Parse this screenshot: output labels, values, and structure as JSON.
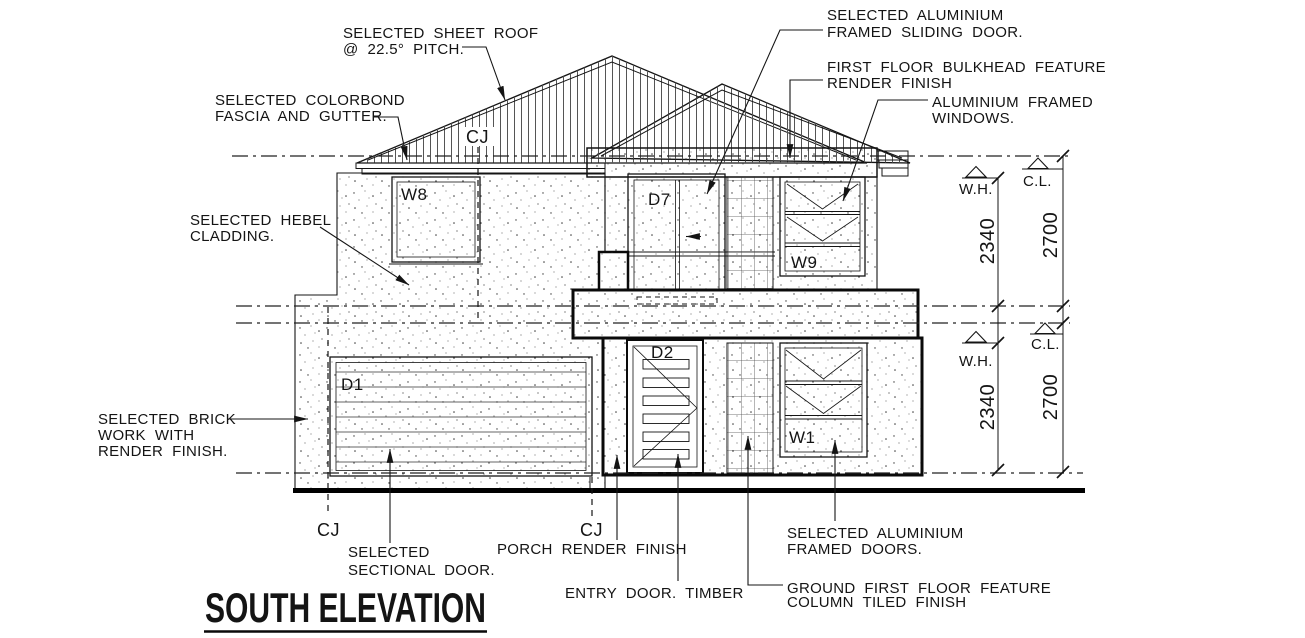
{
  "drawing_title": "SOUTH ELEVATION",
  "callouts": {
    "sheet_roof": {
      "line1": "SELECTED SHEET ROOF",
      "line2": "@ 22.5° PITCH."
    },
    "fascia": {
      "line1": "SELECTED COLORBOND",
      "line2": "FASCIA AND GUTTER."
    },
    "cladding": {
      "line1": "SELECTED HEBEL",
      "line2": "CLADDING."
    },
    "sliding_door": {
      "line1": "SELECTED ALUMINIUM",
      "line2": "FRAMED SLIDING DOOR."
    },
    "bulkhead": {
      "line1": "FIRST FLOOR BULKHEAD FEATURE",
      "line2": "RENDER FINISH"
    },
    "alum_windows": {
      "line1": "ALUMINIUM FRAMED",
      "line2": "WINDOWS."
    },
    "brickwork": {
      "line1": "SELECTED BRICK",
      "line2": "WORK WITH",
      "line3": "RENDER FINISH."
    },
    "sectional_door": {
      "line1": "SELECTED",
      "line2": "SECTIONAL DOOR."
    },
    "porch": "PORCH RENDER FINISH",
    "entry_door": "ENTRY DOOR. TIMBER",
    "framed_doors": {
      "line1": "SELECTED ALUMINIUM",
      "line2": "FRAMED DOORS."
    },
    "feature_column": {
      "line1": "GROUND FIRST FLOOR FEATURE",
      "line2": "COLUMN TILED FINISH"
    }
  },
  "tags": {
    "window_w8": "W8",
    "door_d7": "D7",
    "window_w9": "W9",
    "garage_d1": "D1",
    "entry_d2": "D2",
    "window_w1": "W1",
    "cj_roof": "CJ",
    "cj_left": "CJ",
    "cj_porch": "CJ"
  },
  "dimensions": {
    "upper": {
      "wh_label": "W.H.",
      "cl_label": "C.L.",
      "wh_value": "2340",
      "cl_value": "2700"
    },
    "lower": {
      "wh_label": "W.H.",
      "cl_label": "C.L.",
      "wh_value": "2340",
      "cl_value": "2700"
    }
  },
  "colors": {
    "ink": "#141414",
    "paper": "#ffffff"
  }
}
